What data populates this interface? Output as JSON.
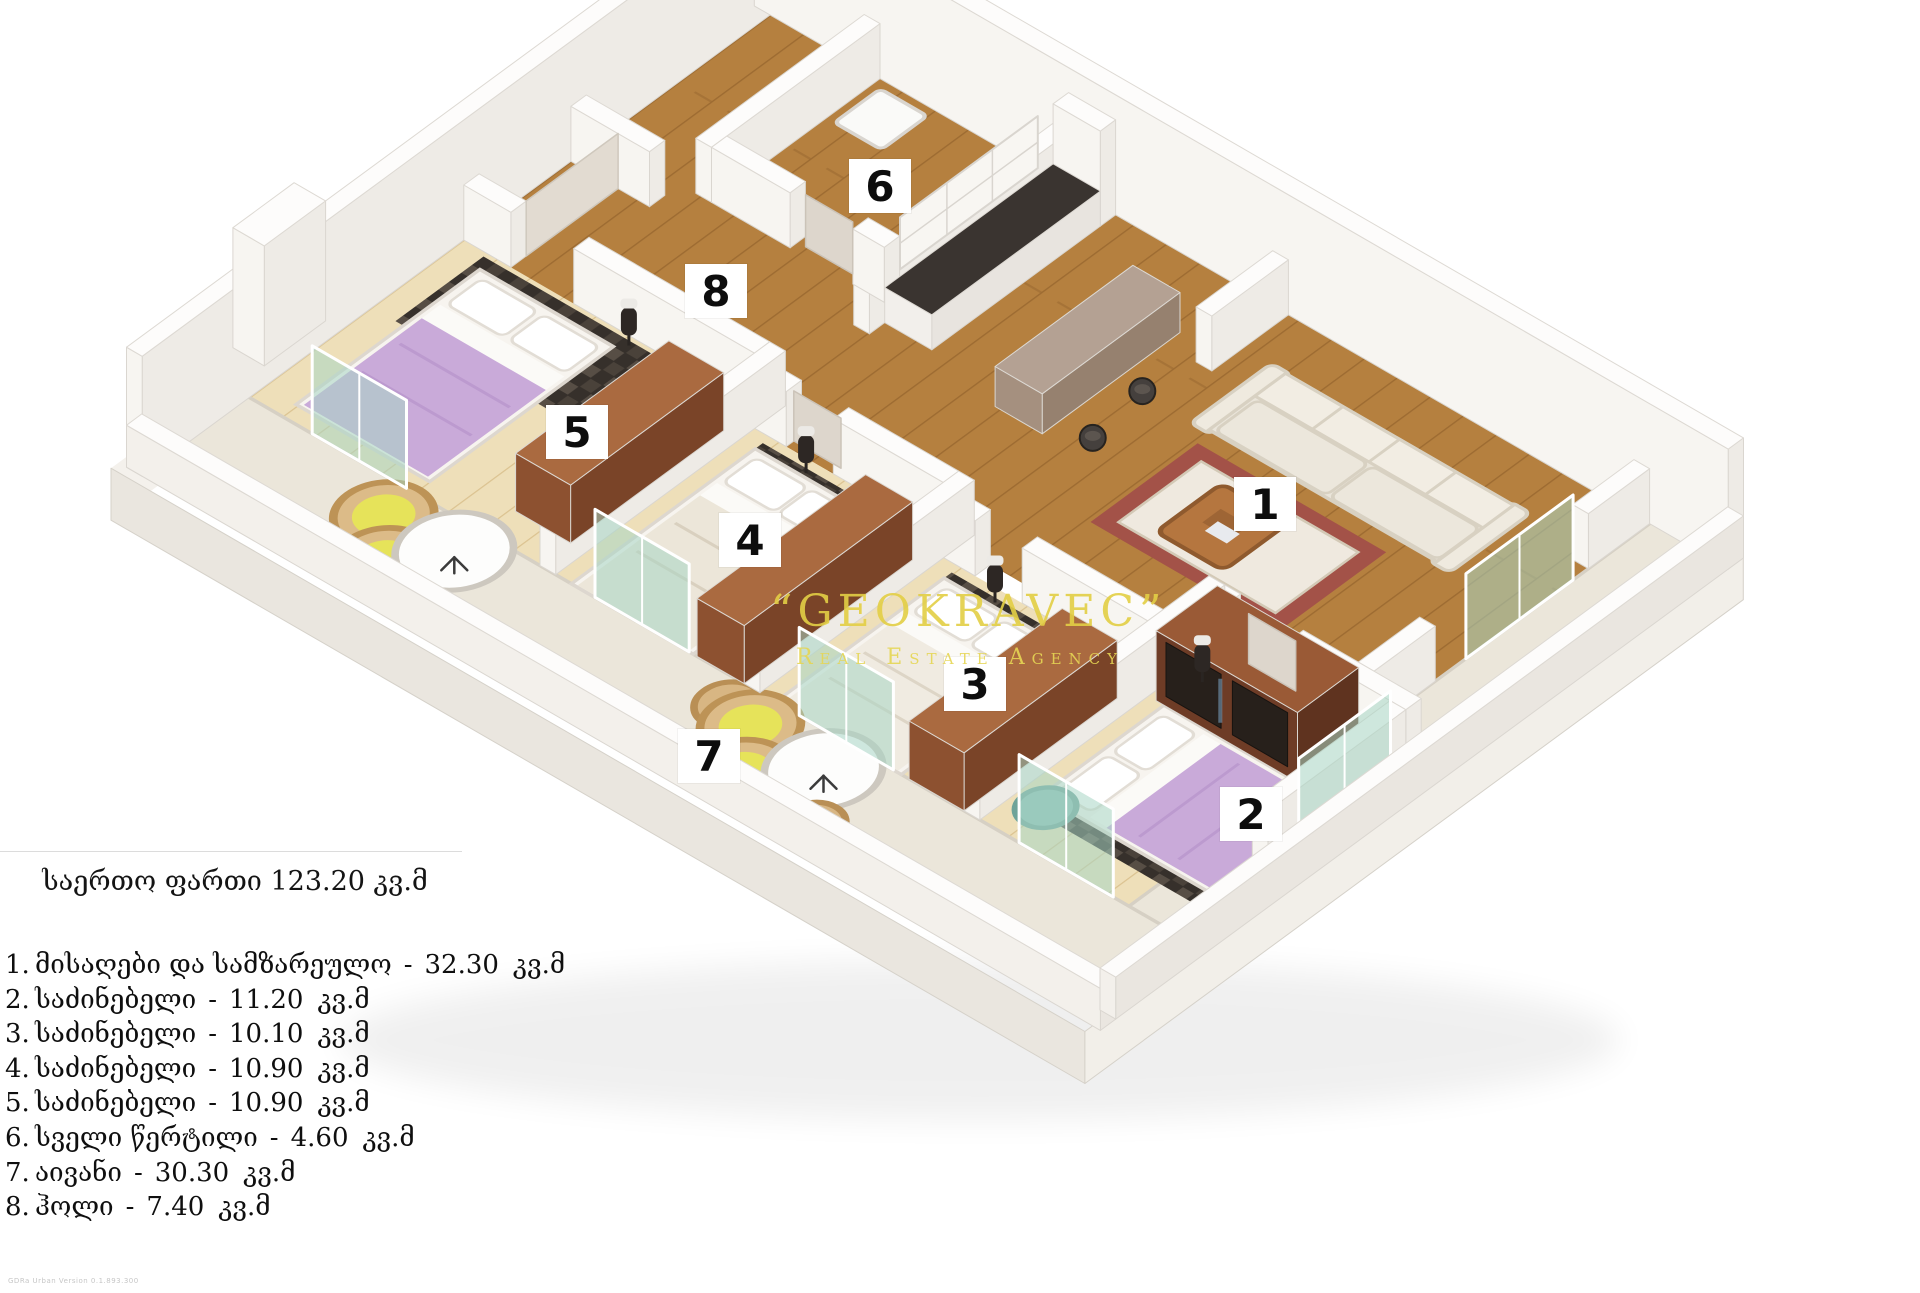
{
  "page": {
    "background": "#ffffff"
  },
  "floor_plan": {
    "rooms": [
      {
        "id": 1,
        "label": "1",
        "name": "living-room-and-kitchen"
      },
      {
        "id": 2,
        "label": "2",
        "name": "bedroom"
      },
      {
        "id": 3,
        "label": "3",
        "name": "bedroom"
      },
      {
        "id": 4,
        "label": "4",
        "name": "bedroom"
      },
      {
        "id": 5,
        "label": "5",
        "name": "bedroom"
      },
      {
        "id": 6,
        "label": "6",
        "name": "wet-point"
      },
      {
        "id": 7,
        "label": "7",
        "name": "balcony"
      },
      {
        "id": 8,
        "label": "8",
        "name": "hall"
      }
    ],
    "watermark": {
      "line1": "“GEOKRAVEC”",
      "line2": "Real Estate Agency"
    }
  },
  "legend": {
    "title": "საერთო ფართი 123.20 კვ.მ",
    "separator": "-",
    "items": [
      {
        "num": "1.",
        "name": "მისაღები და სამზარეულო",
        "area": "32.30",
        "unit": "კვ.მ"
      },
      {
        "num": "2.",
        "name": "საძინებელი",
        "area": "11.20",
        "unit": "კვ.მ"
      },
      {
        "num": "3.",
        "name": "საძინებელი",
        "area": "10.10",
        "unit": "კვ.მ"
      },
      {
        "num": "4.",
        "name": "საძინებელი",
        "area": "10.90",
        "unit": "კვ.მ"
      },
      {
        "num": "5.",
        "name": "საძინებელი",
        "area": "10.90",
        "unit": "კვ.მ"
      },
      {
        "num": "6.",
        "name": "სველი წერტილი",
        "area": "4.60",
        "unit": "კვ.მ"
      },
      {
        "num": "7.",
        "name": "აივანი",
        "area": "30.30",
        "unit": "კვ.მ"
      },
      {
        "num": "8.",
        "name": "ჰოლი",
        "area": "7.40",
        "unit": "კვ.მ"
      }
    ]
  },
  "fine_print": "GDRa Urban Version 0.1.893.300",
  "colors": {
    "accent_yellow": "#e3cf45",
    "floor_wood": "#b5803f",
    "bedroom_wood": "#eedfb9",
    "balcony_floor": "#ebe6da",
    "lilac_bed": "#c9aad9",
    "walnut": "#8c4e2e",
    "dark_rug": "#36302b",
    "rug_maroon": "#a35248",
    "glass_teal": "#a8d6c4"
  }
}
